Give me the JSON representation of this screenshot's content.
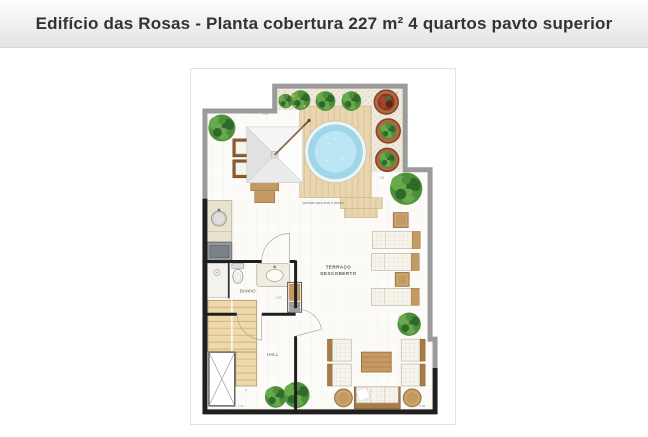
{
  "header": {
    "title": "Edifício das Rosas - Planta cobertura 227 m² 4 quartos pavto superior"
  },
  "floor_plan": {
    "labels": {
      "terrace_line1": "TERRAÇO",
      "terrace_line2": "DESCOBERTO",
      "bathroom": "BANHO",
      "hall": "HALL",
      "deck_note": "previsão para deck e piscina",
      "stair_number": "8"
    },
    "dimensions": [
      "4.01",
      "4.91",
      "7.06",
      "2.94",
      "1.61",
      "5.26"
    ],
    "features": [
      "circular pool on wooden deck",
      "gravel planter band with shrubs and terracotta pots",
      "dining table with white parasol and chairs",
      "gourmet counter with round sink and grill",
      "bathroom with shower stall, toilet and washbasin",
      "internal staircase with open void",
      "three sun loungers with side tables",
      "lounge set: four armchairs, coffee table, sofa, two round poufs",
      "potted plants"
    ]
  },
  "colors": {
    "header-bg-top": "#fdfdfd",
    "header-bg-bottom": "#e3e3e3",
    "title-color": "#333333",
    "frame-border": "#e2e2e2",
    "wall-gray": "#9b9b9b",
    "wall-black": "#1f1f1f",
    "floor": "#fcfbf8",
    "gravel": "#efe8db",
    "deck": "#e9d6ae",
    "deck-line": "#d2ba8c",
    "pool": "#bce6f3",
    "pool-edge": "#9fd6e8",
    "wood": "#c49a62",
    "wood-dark": "#a87c48",
    "cushion": "#f7f4ec",
    "g1": "#4e8f3c",
    "g2": "#68a94e",
    "g3": "#2f6a2a",
    "pot": "#b2683f",
    "label-color": "#5a5a5a"
  }
}
